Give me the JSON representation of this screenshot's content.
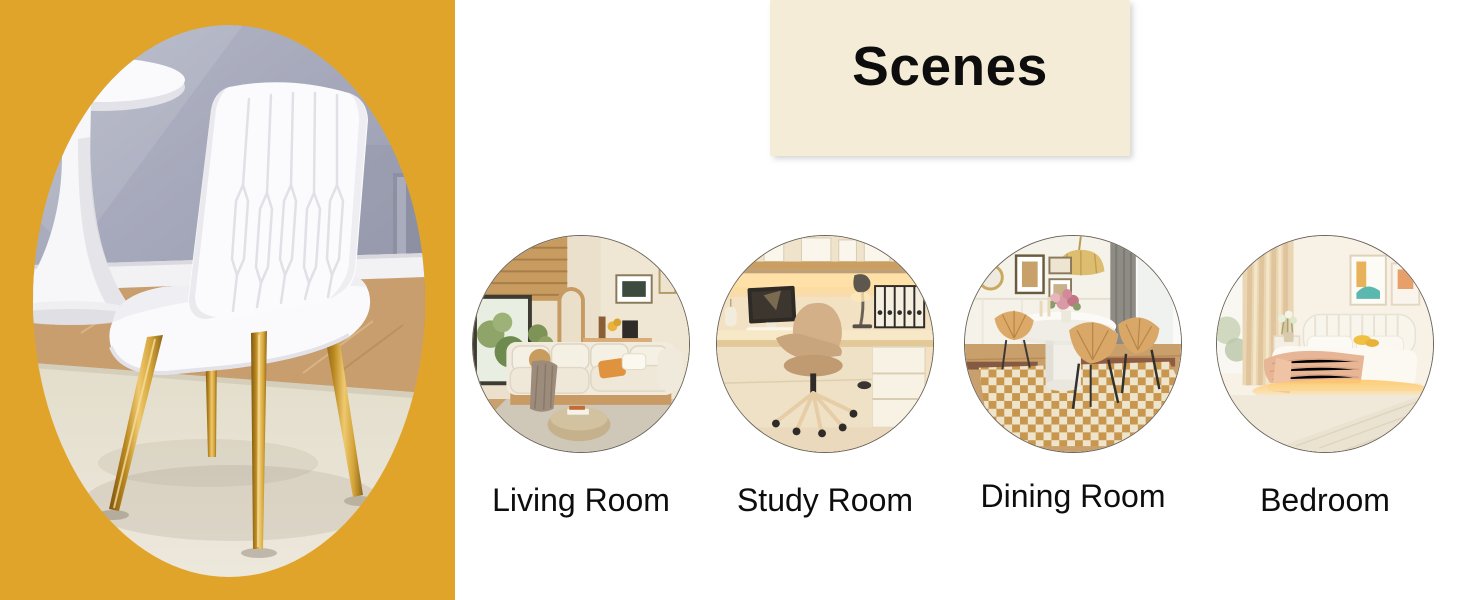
{
  "header": {
    "title": "Scenes",
    "bg_color": "#F4ECD7",
    "text_color": "#0d0d0d"
  },
  "left_panel": {
    "bg_color": "#E0A42B",
    "photo_subject": "white-upholstered-dining-chair-with-gold-legs"
  },
  "scenes": {
    "items": [
      {
        "label": "Living Room"
      },
      {
        "label": "Study Room"
      },
      {
        "label": "Dining Room"
      },
      {
        "label": "Bedroom"
      }
    ]
  },
  "colors": {
    "accent_yellow": "#E0A42B",
    "header_cream": "#F4ECD7",
    "gold_leg": "#C8922C",
    "label_text": "#0d0d0d"
  }
}
